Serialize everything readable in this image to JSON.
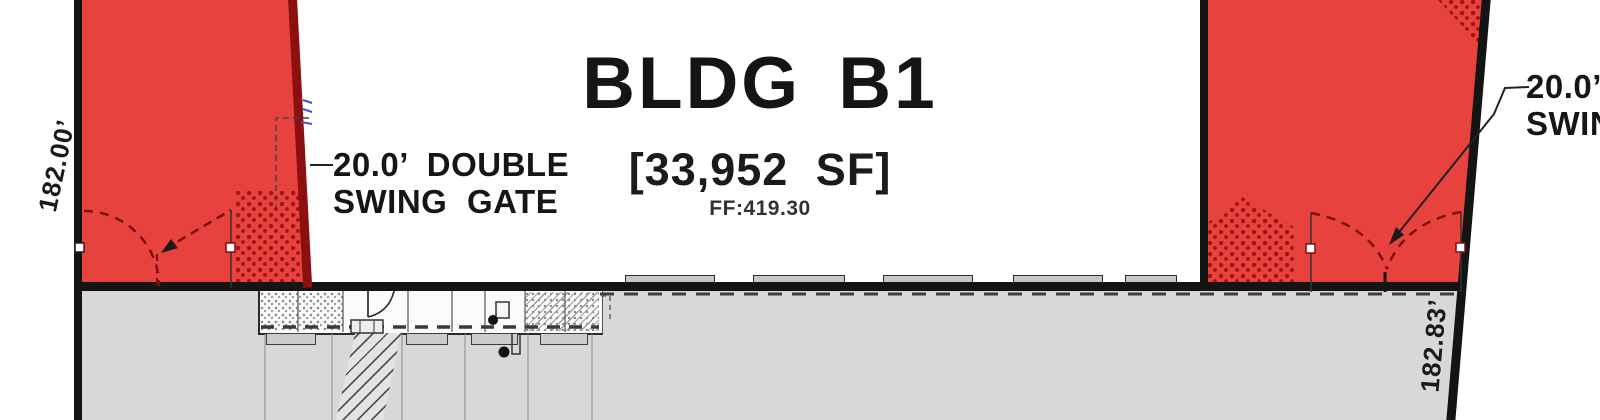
{
  "plan": {
    "building": {
      "title": "BLDG B1",
      "area_sf": "[33,952 SF]",
      "finished_floor": "FF:419.30"
    },
    "gate_left": {
      "line1": "20.0’ DOUBLE",
      "line2": "SWING GATE"
    },
    "gate_right": {
      "line1": "20.0’ DOUBLE",
      "line2": "SWING GATE"
    },
    "dimensions": {
      "west_property_line": "182.00’",
      "east_property_line": "182.83’"
    },
    "colors": {
      "fire_lane_red": "#e8423f",
      "rated_wall_maroon": "#8c1010",
      "pavement_gray": "#d8d8d8",
      "line_black": "#141414"
    }
  }
}
